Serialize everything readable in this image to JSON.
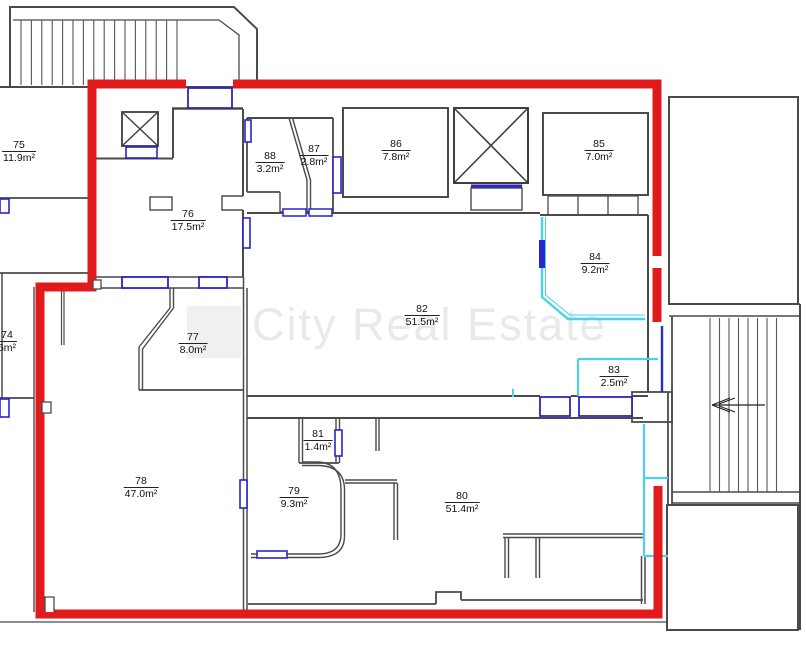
{
  "watermark": {
    "text": "City Real Estate"
  },
  "rooms": [
    {
      "id": "74",
      "area": "6m²"
    },
    {
      "id": "75",
      "area": "11.9m²"
    },
    {
      "id": "76",
      "area": "17.5m²"
    },
    {
      "id": "77",
      "area": "8.0m²"
    },
    {
      "id": "78",
      "area": "47.0m²"
    },
    {
      "id": "79",
      "area": "9.3m²"
    },
    {
      "id": "80",
      "area": "51.4m²"
    },
    {
      "id": "81",
      "area": "1.4m²"
    },
    {
      "id": "82",
      "area": "51.5m²"
    },
    {
      "id": "83",
      "area": "2.5m²"
    },
    {
      "id": "84",
      "area": "9.2m²"
    },
    {
      "id": "85",
      "area": "7.0m²"
    },
    {
      "id": "86",
      "area": "7.8m²"
    },
    {
      "id": "87",
      "area": "2.8m²"
    },
    {
      "id": "88",
      "area": "3.2m²"
    }
  ],
  "colors": {
    "highlight_outline": "#e11b1b",
    "wall": "#4a4a4a",
    "window_marker_blue": "#2626cc",
    "glass_wall_cyan": "#4cd0ec",
    "watermark_gray": "#e9e9e9"
  }
}
